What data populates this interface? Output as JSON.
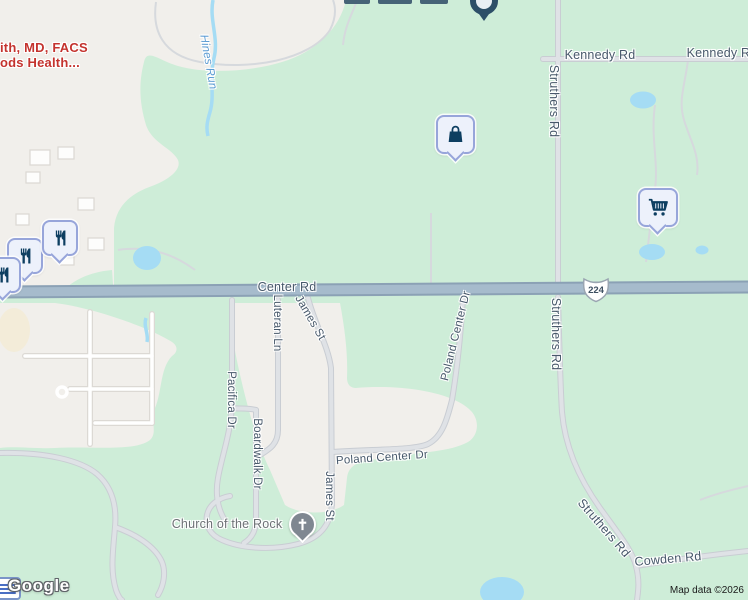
{
  "labels": {
    "kennedy_1": "Kennedy Rd",
    "kennedy_2": "Kennedy Rd",
    "struthers_north": "Struthers Rd",
    "struthers_mid": "Struthers Rd",
    "struthers_south": "Struthers Rd",
    "center_rd": "Center Rd",
    "cowden_rd": "Cowden Rd",
    "luteran_ln": "Luteran Ln",
    "james_st_upper": "James St",
    "james_st_lower": "James St",
    "pacifica_dr": "Pacifica Dr",
    "boardwalk_dr": "Boardwalk Dr",
    "poland_center_diag": "Poland Center Dr",
    "poland_center_horiz": "Poland Center Dr",
    "edge_fragment": "an Rd"
  },
  "water": {
    "hines_run": "Hines Run"
  },
  "pois": {
    "business_line1": "ith, MD, FACS",
    "business_line2": "ods Health...",
    "church": "Church of the Rock"
  },
  "shield": {
    "us224": "224"
  },
  "footer": {
    "logo": "Google",
    "attribution": "Map data ©2026"
  },
  "markers": {
    "shopping_bag": {
      "icon": "shopping-bag-icon"
    },
    "grocery_cart": {
      "icon": "shopping-cart-icon"
    },
    "restaurant_1": {
      "icon": "restaurant-icon"
    },
    "restaurant_2": {
      "icon": "restaurant-icon"
    },
    "restaurant_3": {
      "icon": "restaurant-icon"
    },
    "church_pin": {
      "icon": "church-cross-icon"
    },
    "clipped_top_pin": {
      "icon": "generic-pin-icon"
    }
  },
  "colors": {
    "land_green": "#ceedd8",
    "urban_area": "#f1efeb",
    "highway_fill": "#a6bbcc",
    "highway_casing": "#8ba1b5",
    "minor_road": "#dfe2e6",
    "water": "#a5dcf4",
    "road_label": "#47586a",
    "water_label": "#5b9bd3",
    "poi_red": "#c4332e",
    "marker_bg": "#edf1fb",
    "marker_border": "#97a5da",
    "marker_icon": "#0d3e61",
    "church_pin_gray": "#7f8791"
  }
}
